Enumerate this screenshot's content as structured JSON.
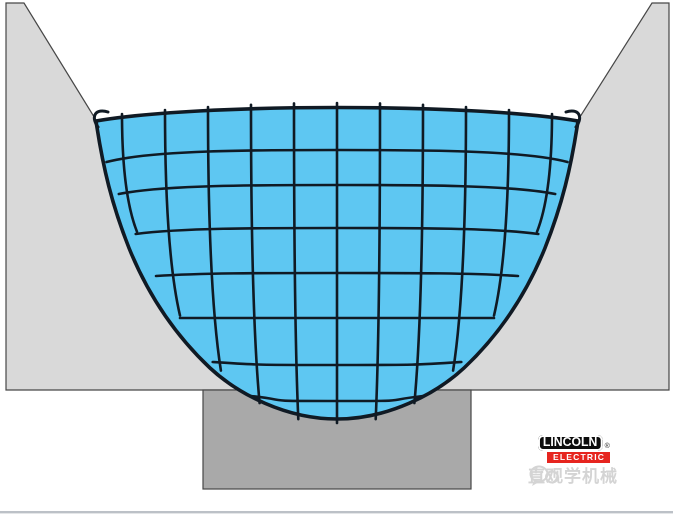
{
  "colors": {
    "background": "#ffffff",
    "plate_gray": "#d9d9d9",
    "backing_gray": "#a9a9a9",
    "pool_blue": "#5ec7f2",
    "mesh_dark": "#101a24",
    "outline_dark": "#474747",
    "separator_gray": "#bcc1c7",
    "lincoln_black": "#0d0d0d",
    "lincoln_red": "#e6251f",
    "watermark_gray": "#c6c6c6"
  },
  "branding": {
    "lincoln_label": "LINCOLN",
    "electric_label": "ELECTRIC",
    "registered_mark": "®",
    "watermark_text": "直观学机械"
  },
  "mesh": {
    "vertical_x": [
      122,
      165,
      208,
      251,
      294,
      337,
      380,
      423,
      466,
      509,
      552
    ],
    "horizontal_y": [
      150,
      185,
      228,
      273,
      318,
      365,
      401
    ],
    "horizontal_end_drop": [
      12,
      9,
      6,
      3,
      0,
      -3,
      -5
    ]
  },
  "pool_geometry": {
    "cx": 337,
    "top_corner_y": 121,
    "top_peak_y": 107,
    "bottom_y": 419,
    "half_width": 241,
    "wall_span": 298,
    "wall_exponent": 0.42,
    "tick": 4
  }
}
